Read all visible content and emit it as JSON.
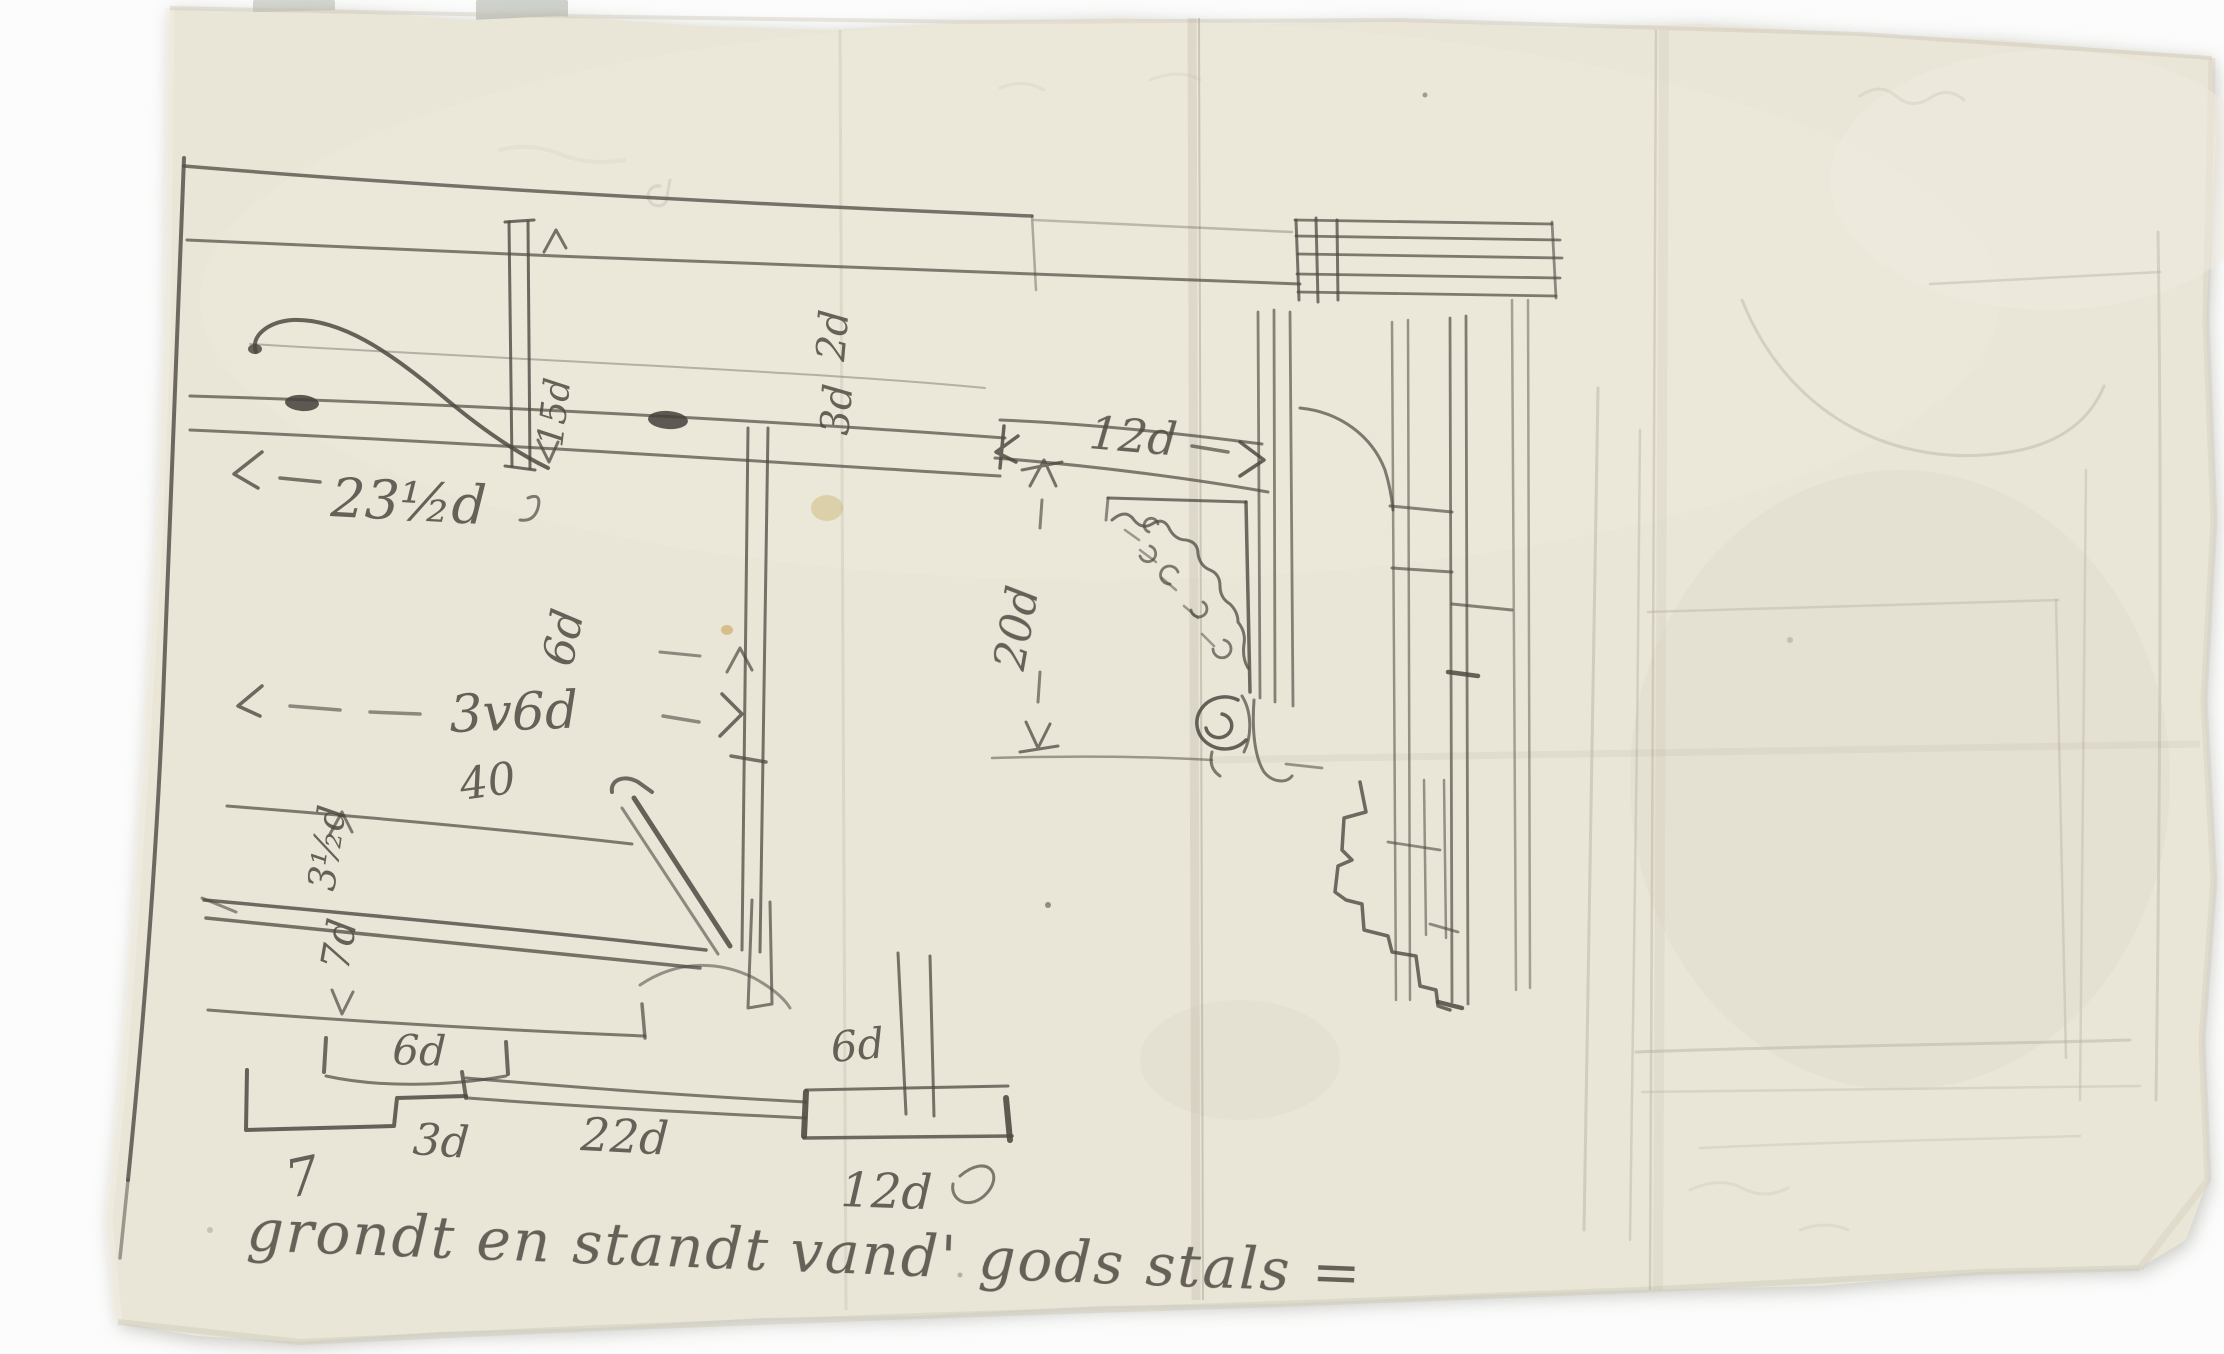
{
  "artifact": {
    "kind": "pencil architectural sketch on torn aged paper",
    "description": "plan and elevation sketch of a stable with dimension notes in duim (d) and voet (v)"
  },
  "colors": {
    "backdrop": "#fbfcfb",
    "paper": "#e9e5d7",
    "paper_highlight": "#f0ecdf",
    "paper_edge": "#d8d3c2",
    "pencil": "#4e4a42",
    "pencil_faint": "#b3ac9b",
    "tab": "#d5d7d1",
    "stain": "#c9b470"
  },
  "labels": {
    "dim_width_left": "23½d",
    "dim_opening_top": "12d",
    "dim_post_height": "15d",
    "dim_console_height": "20d",
    "dim_width_main": "3v6d",
    "note_40": "40",
    "curl_upper": "2d",
    "curl_lower": "3d",
    "dim_post_width": "6d",
    "dim_rail_a": "3½d",
    "dim_rail_b": "7d",
    "plan_6d_left": "6d",
    "plan_3d": "3d",
    "plan_22d": "22d",
    "plan_6d_right": "6d",
    "plan_12d": "12d",
    "plan_tick": "7"
  },
  "caption": {
    "text": "grondt en standt vand' gods stals ="
  }
}
